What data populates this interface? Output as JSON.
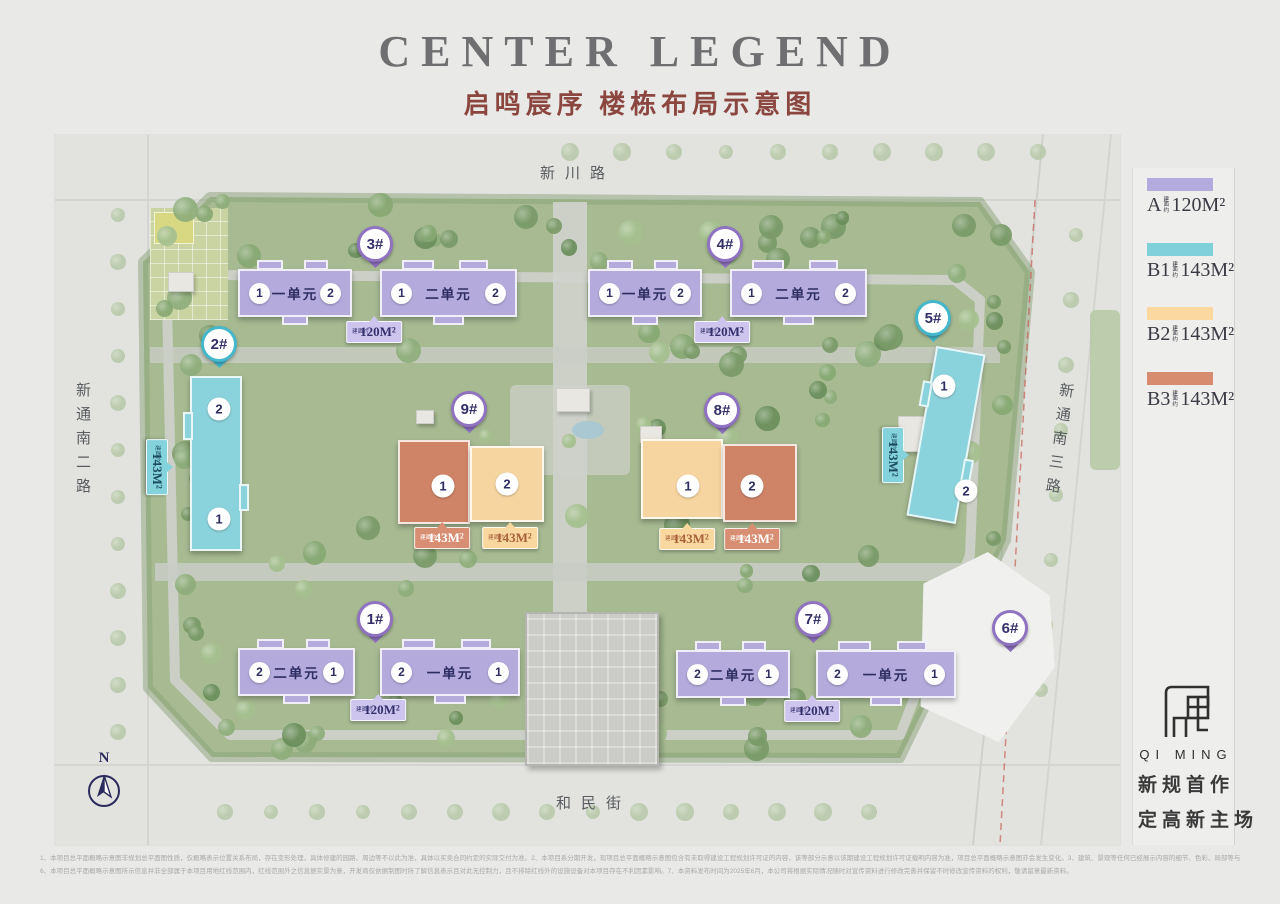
{
  "page": {
    "title": "CENTER LEGEND",
    "subtitle": "启鸣宸序 楼栋布局示意图"
  },
  "roads": {
    "top": "新川路",
    "bottom": "和民街",
    "left": "新通南二路",
    "right": "新通南三路"
  },
  "compass": {
    "label": "N"
  },
  "legend": [
    {
      "code": "A",
      "prefix": "建面约",
      "area": "120M²",
      "color": "#b3abde"
    },
    {
      "code": "B1",
      "prefix": "建面约",
      "area": "143M²",
      "color": "#7fd0da"
    },
    {
      "code": "B2",
      "prefix": "建面约",
      "area": "143M²",
      "color": "#fbd8a0"
    },
    {
      "code": "B3",
      "prefix": "建面约",
      "area": "143M²",
      "color": "#d78b6f"
    }
  ],
  "map": {
    "tag_prefix": "建面约",
    "pins": {
      "b1": "1#",
      "b2": "2#",
      "b3": "3#",
      "b4": "4#",
      "b5": "5#",
      "b6": "6#",
      "b7": "7#",
      "b8": "8#",
      "b9": "9#"
    },
    "slab_pairs": [
      {
        "id": "b3",
        "left": {
          "n1": "1",
          "label": "一单元",
          "n2": "2"
        },
        "right": {
          "n1": "1",
          "label": "二单元",
          "n2": "2"
        },
        "tag": "120M²"
      },
      {
        "id": "b4",
        "left": {
          "n1": "1",
          "label": "一单元",
          "n2": "2"
        },
        "right": {
          "n1": "1",
          "label": "二单元",
          "n2": "2"
        },
        "tag": "120M²"
      },
      {
        "id": "b1",
        "left": {
          "n1": "2",
          "label": "二单元",
          "n2": "1"
        },
        "right": {
          "n1": "2",
          "label": "一单元",
          "n2": "1"
        },
        "tag": "120M²"
      },
      {
        "id": "b7",
        "left": {
          "n1": "2",
          "label": "二单元",
          "n2": "1"
        },
        "right": {
          "n1": "2",
          "label": "一单元",
          "n2": "1"
        },
        "tag": "120M²"
      }
    ],
    "towers": [
      {
        "id": "b2",
        "top": "2",
        "bottom": "1",
        "tag": "143M²"
      },
      {
        "id": "b5",
        "top": "1",
        "bottom": "2",
        "tag": "143M²"
      }
    ],
    "duo_pairs": [
      {
        "id": "b9",
        "halves": [
          {
            "n": "1",
            "type": "B3",
            "tag": "143M²"
          },
          {
            "n": "2",
            "type": "B2",
            "tag": "143M²"
          }
        ]
      },
      {
        "id": "b8",
        "halves": [
          {
            "n": "1",
            "type": "B2",
            "tag": "143M²"
          },
          {
            "n": "2",
            "type": "B3",
            "tag": "143M²"
          }
        ]
      }
    ]
  },
  "logo": {
    "latin": "QI MING",
    "slogan": [
      "新规首作",
      "定高新主场"
    ]
  },
  "disclaimer": [
    "1、本项目总平面概略示意图非规划总平面图性质，仅概略表示位置关系布局，存在变形处理，具体修建的园路、周边等不以此为准，具体以买卖合同约定的实际交付为准。2、本项目系分期开发，现项目总平面概略示意图包含有未取得建设工程规划许可证的内容，该等部分示意以该期建设工程规划许可证载明内容为准，项目总平面概略示意图亦会发生变化。3、建筑、景观等任何已经展示内容的细节、色彩、局部等与实况存在差异，最终以实况为准。4、受比例等限制，现项目总平面概略示意图并非完全按实制作，亦存在未予展示之内容，具体建设结果会与本项目总平面概略示意图效果存在区别。5、本项目总平面概略示意图未予呈现所有展示设施设备、功能性用房的一切规划设计信息，且已示信息亦存在不具体不确定因素，将可能会发生修改，所示交付结果以政府部门批复文件以及双方合同约定内容为准。",
    "6、本项目总平面概略示意图所示信息并非全部属于本项目用地红线范围内，红线范围外之信息据实景为意，开发商仅依据制图时所了解信息表示且对此无控制力，且不排除红线外的设施设备对本项目存在不利因素影响。7、本资料发布时间为2025年6月，本公司将根据实际情况随时对宣传资料进行修改完善并保留不时修改宣传资料的权利，敬请留意最新资料。"
  ]
}
